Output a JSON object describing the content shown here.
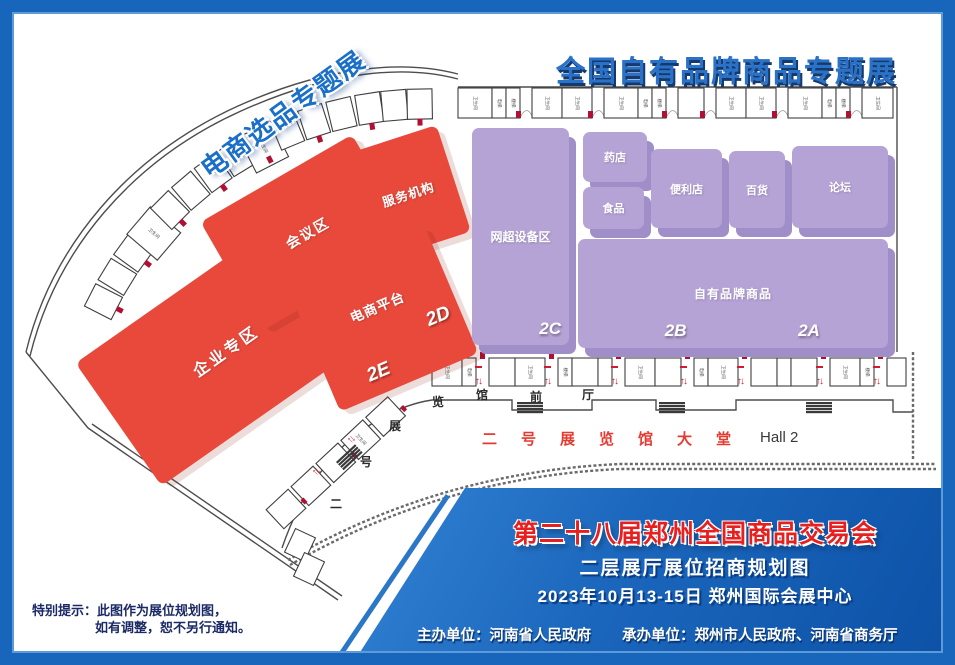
{
  "colors": {
    "frame_blue": "#1766bb",
    "zone_red": "#e8493b",
    "zone_purple": "#b6a3d6",
    "map_title_blue": "#2a72c8",
    "footer_title_red": "#e7201f",
    "corridor_red": "#e63a30",
    "note_navy": "#1b2a66",
    "door_marker_red": "#b01031"
  },
  "titles": {
    "main": "全国自有品牌商品专题展",
    "diagonal": "电商选品专题展"
  },
  "zones": {
    "red": {
      "enterprise": {
        "name": "企业专区",
        "code": "2F"
      },
      "meeting": {
        "name": "会议区"
      },
      "service": {
        "name": "服务机构"
      },
      "ecommerce": {
        "name": "电商平台",
        "codes": [
          "2E",
          "2D"
        ]
      }
    },
    "purple": {
      "netmarket": {
        "name": "网超设备区",
        "code": "2C"
      },
      "drugstore": {
        "name": "药店"
      },
      "food": {
        "name": "食品"
      },
      "convenience": {
        "name": "便利店"
      },
      "department": {
        "name": "百货"
      },
      "forum": {
        "name": "论坛"
      },
      "private_label": {
        "name": "自有品牌商品",
        "codes": [
          "2B",
          "2A"
        ]
      }
    }
  },
  "corridor": {
    "front_chars": [
      "二",
      "号",
      "展",
      "览",
      "馆",
      "前",
      "厅"
    ],
    "lobby": "二号展览馆大堂",
    "hall_en": "Hall 2"
  },
  "plan": {
    "facilities": [
      "卫生间",
      "电梯",
      "楼梯"
    ]
  },
  "footer": {
    "title": "第二十八届郑州全国商品交易会",
    "subtitle": "二层展厅展位招商规划图",
    "date_venue": "2023年10月13-15日 郑州国际会展中心",
    "host": "主办单位：河南省人民政府",
    "organizer": "承办单位：郑州市人民政府、河南省商务厅",
    "note_label": "特别提示：",
    "note_line1": "此图作为展位规划图，",
    "note_line2": "如有调整，恕不另行通知。"
  }
}
